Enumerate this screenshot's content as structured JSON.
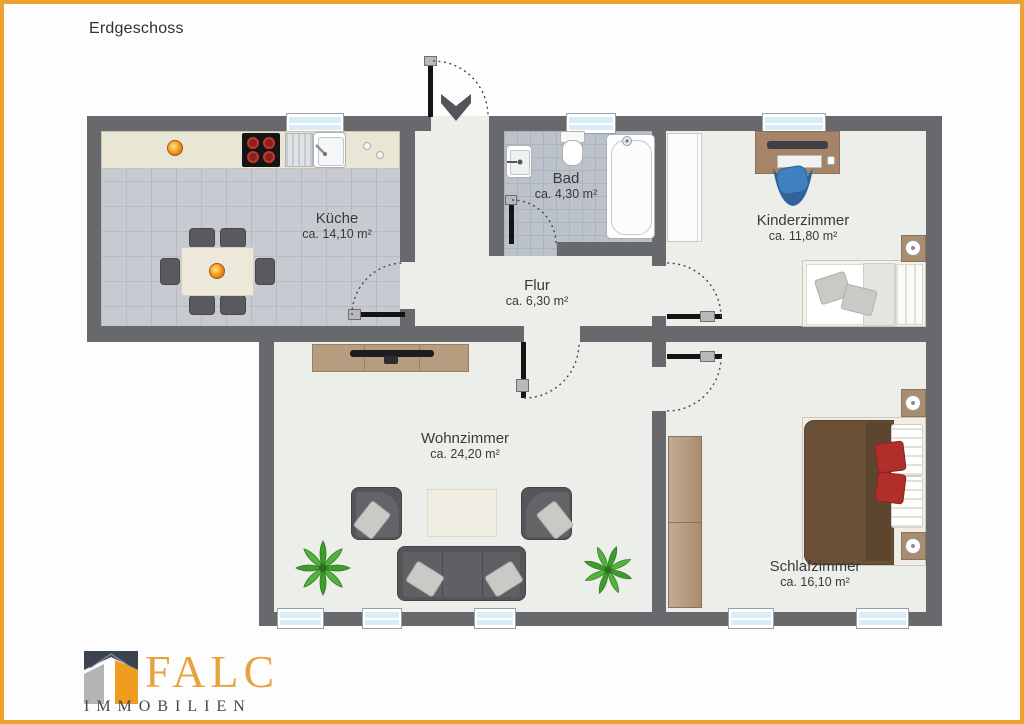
{
  "title": "Erdgeschoss",
  "rooms": {
    "kueche": {
      "name": "Küche",
      "area": "ca. 14,10 m²"
    },
    "bad": {
      "name": "Bad",
      "area": "ca. 4,30 m²"
    },
    "kinderzimmer": {
      "name": "Kinderzimmer",
      "area": "ca. 11,80 m²"
    },
    "flur": {
      "name": "Flur",
      "area": "ca. 6,30 m²"
    },
    "wohnzimmer": {
      "name": "Wohnzimmer",
      "area": "ca. 24,20 m²"
    },
    "schlafzimmer": {
      "name": "Schlafzimmer",
      "area": "ca. 16,10 m²"
    }
  },
  "logo": {
    "brand": "FALC",
    "subtitle": "IMMOBILIEN"
  },
  "palette": {
    "border_orange": "#EFA12F",
    "wall_gray": "#68696D",
    "room_floor": "#ECEEEA",
    "kitchen_tile": "#C7CBD1",
    "bath_tile": "#BCC2C9",
    "window_glass": "#D9EDF8",
    "door_black": "#141414",
    "label_text": "#3A3A3A",
    "logo_orange": "#E8A43C",
    "logo_dark": "#3B4250",
    "wood": "#B79D80",
    "sofa_gray": "#56565A",
    "plant_green": "#3F9B2F",
    "bed_brown": "#6A5036",
    "pillow_red": "#B02F2A",
    "chair_blue": "#3F80BF"
  }
}
